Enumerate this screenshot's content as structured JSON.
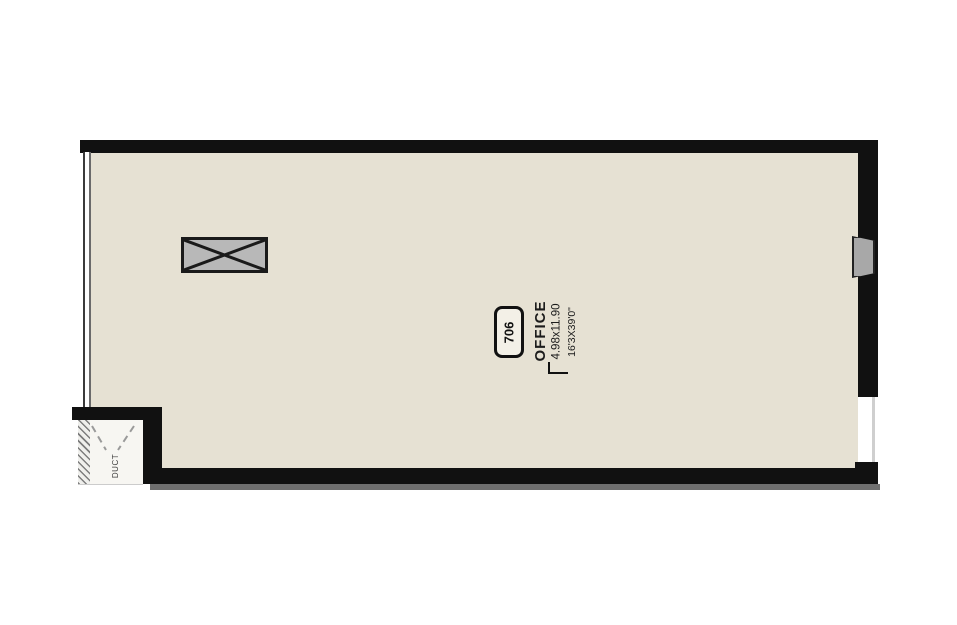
{
  "floorplan": {
    "room_tag": "706",
    "room_name": "OFFICE",
    "room_dimensions_meters": "4.98x11.90",
    "room_dimensions_feet": "16'3X39'0\"",
    "shaft_label": "DUCT",
    "colors": {
      "floor_fill": "#e6e1d3",
      "wall": "#111111",
      "column_fill": "#b8b8b8",
      "panel_fill": "#a8a8a8"
    }
  }
}
